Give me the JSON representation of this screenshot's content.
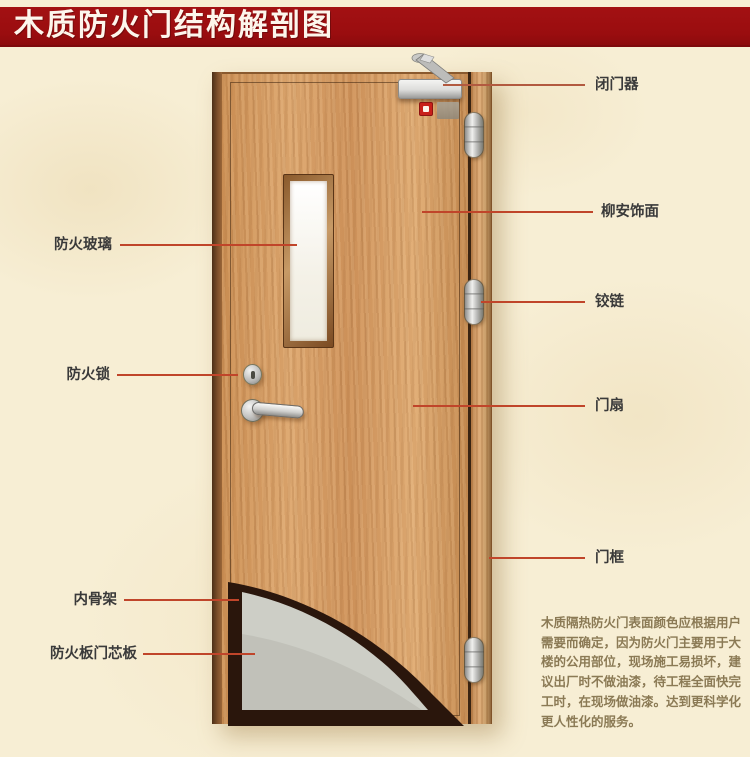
{
  "title": "木质防火门结构解剖图",
  "callouts": {
    "left": [
      {
        "text": "防火玻璃"
      },
      {
        "text": "防火锁"
      },
      {
        "text": "内骨架"
      },
      {
        "text": "防火板门芯板"
      }
    ],
    "right": [
      {
        "text": "闭门器"
      },
      {
        "text": "柳安饰面"
      },
      {
        "text": "铰链"
      },
      {
        "text": "门扇"
      },
      {
        "text": "门框"
      }
    ]
  },
  "description": {
    "lines": [
      "木质隔热防火门表面颜色应根据用户",
      "需要而确定，因为防火门主要用于大",
      "楼的公用部位，现场施工易损坏，建",
      "议出厂时不做油漆，待工程全面快完",
      "工时，在现场做油漆。达到更科学化",
      "更人性化的服务。"
    ]
  },
  "colors": {
    "banner_red": "#9a0d0f",
    "leader_line_red": "#c0452a",
    "background_cream": "#f7eed4",
    "door_wood": "#d49a63",
    "label_text": "#3a3a3a",
    "description_text": "#8b7a55",
    "core_board_gray": "#cdcec6",
    "inner_frame_dark": "#2a160c"
  }
}
